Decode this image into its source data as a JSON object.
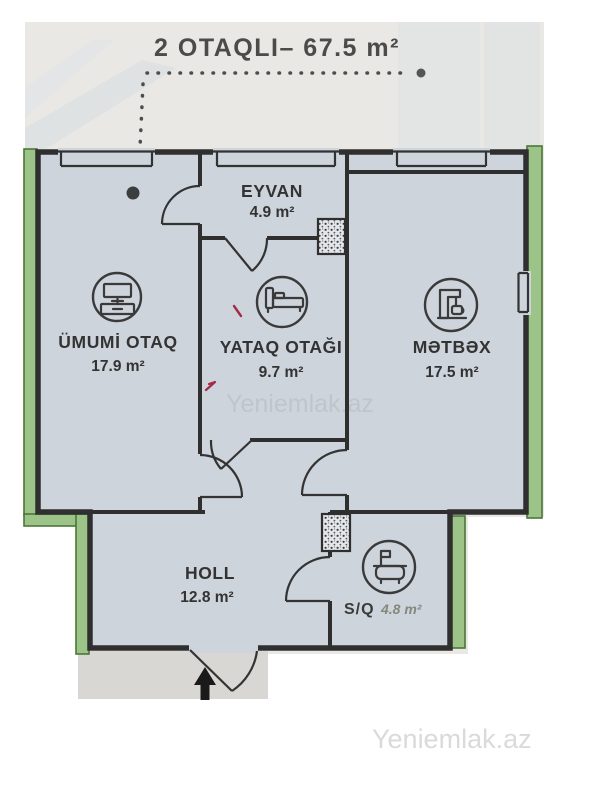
{
  "title": "2 OTAQLI– 67.5 m²",
  "rooms": [
    {
      "name": "EYVAN",
      "area": "4.9 m²"
    },
    {
      "name": "ÜMUMİ OTAQ",
      "area": "17.9 m²",
      "icon": "tv-cabinet-icon"
    },
    {
      "name": "YATAQ OTAĞI",
      "area": "9.7 m²",
      "icon": "bed-icon"
    },
    {
      "name": "MƏTBƏX",
      "area": "17.5 m²",
      "icon": "coffee-machine-icon"
    },
    {
      "name": "HOLL",
      "area": "12.8 m²"
    },
    {
      "name": "S/Q",
      "area": "4.8 m²",
      "icon": "bathtub-icon"
    }
  ],
  "watermarks": {
    "center": "Yeniemlak.az",
    "bottom_right": "Yeniemlak.az"
  },
  "colors": {
    "wall": "#2f2f2f",
    "floor": "#cdd4db",
    "photo_bg": "#e9e8e5",
    "green_fill": "#9cc489",
    "green_border": "#4c7637",
    "label": "#333333",
    "entry_floor": "#d9d7d3",
    "watermark_center": "#b7babd",
    "watermark_bottom": "#dadada",
    "red_mark": "#a12c44"
  }
}
